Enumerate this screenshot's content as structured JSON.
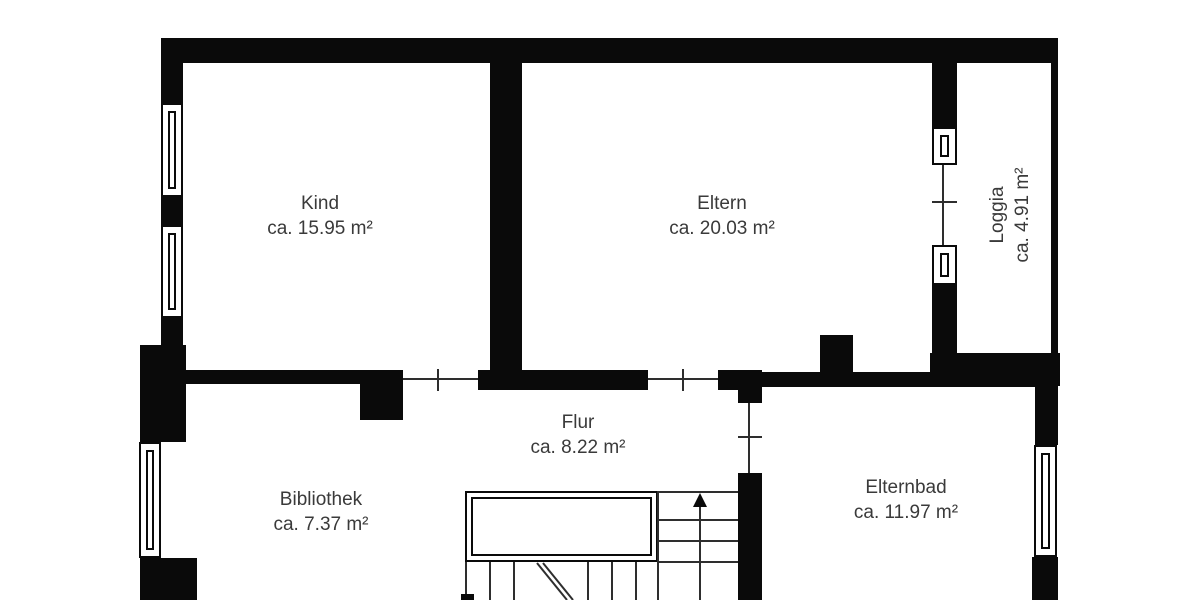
{
  "plan_type": "floor-plan",
  "colors": {
    "background": "#ffffff",
    "wall": "#0a0a0a",
    "line": "#2e2e2e",
    "text": "#3a3a3a"
  },
  "rooms": {
    "kind": {
      "name": "Kind",
      "area": "ca. 15.95 m²"
    },
    "eltern": {
      "name": "Eltern",
      "area": "ca. 20.03 m²"
    },
    "loggia": {
      "name": "Loggia",
      "area": "ca. 4.91 m²"
    },
    "flur": {
      "name": "Flur",
      "area": "ca. 8.22 m²"
    },
    "bibliothek": {
      "name": "Bibliothek",
      "area": "ca. 7.37 m²"
    },
    "elternbad": {
      "name": "Elternbad",
      "area": "ca. 11.97 m²"
    }
  },
  "stairs": {
    "direction": "up"
  }
}
